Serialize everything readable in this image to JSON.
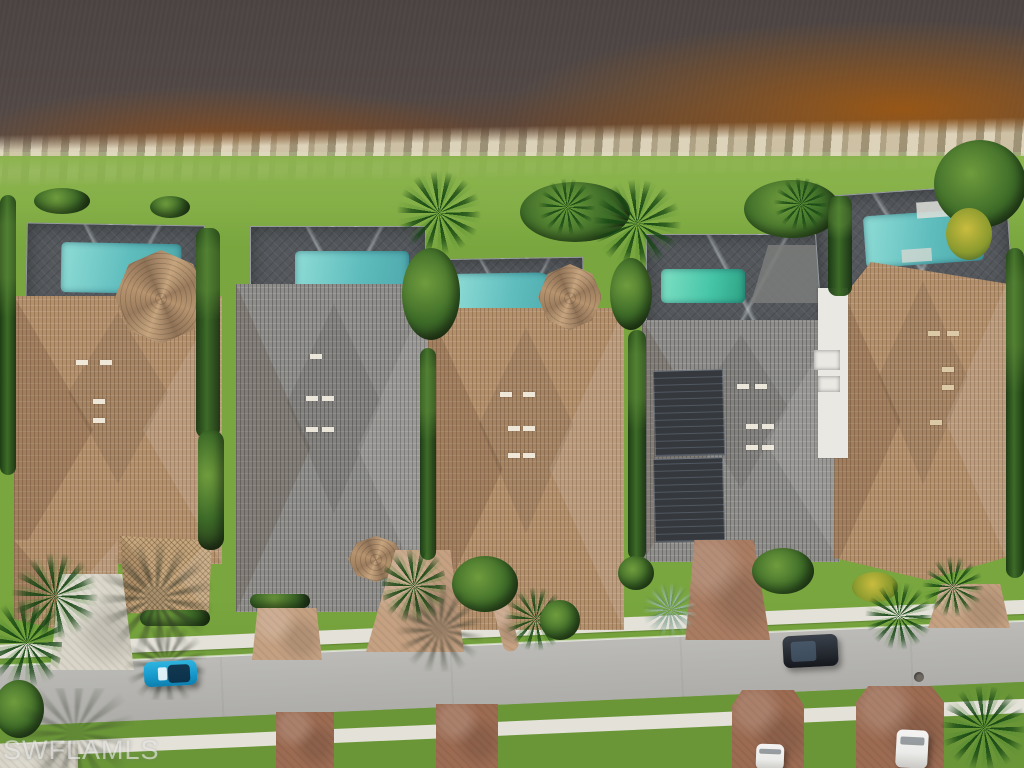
{
  "watermark": {
    "text": "SWFLAMLS"
  },
  "colors": {
    "water": "#4a4342",
    "rust": "#9a5512",
    "shore": "#cdc5ac",
    "lawn": "#79a63e",
    "lawn2": "#8ab34c",
    "lawn3": "#6a9638",
    "hedge": "#3d6b28",
    "palm2": "#6f9c3d",
    "rooftan": "#b3906c",
    "roofgray": "#8e8d89",
    "cage": "#54585c",
    "pool": "#5fbdbd",
    "pool2": "#45c4a6",
    "street": "#b6b5b1",
    "walk": "#e3e1d8",
    "drivetan": "#c5a182",
    "drivelight": "#d9d5c8",
    "drivered": "#9c6b52",
    "carteal": "#1899cc",
    "cardark": "#252a31",
    "carwhite": "#ebebe9",
    "solar": "#35383c",
    "wall": "#e9e8e3",
    "flower": "#c9bc3f"
  },
  "scene": {
    "type": "aerial-drone-photo",
    "setting": "waterfront residential street with five homes, screened pools, lake at top",
    "houses": [
      {
        "id": 1,
        "roof": "tan",
        "pool": true
      },
      {
        "id": 2,
        "roof": "gray",
        "pool": true
      },
      {
        "id": 3,
        "roof": "tan",
        "pool": true
      },
      {
        "id": 4,
        "roof": "gray",
        "pool": true,
        "solar_panels": true
      },
      {
        "id": 5,
        "roof": "tan",
        "pool": true
      }
    ],
    "vehicles": [
      {
        "color": "teal",
        "location": "street-left"
      },
      {
        "color": "dark",
        "location": "street-right"
      },
      {
        "color": "white",
        "location": "driveway-bottom-right"
      },
      {
        "color": "white",
        "location": "driveway-bottom-partial"
      }
    ]
  }
}
